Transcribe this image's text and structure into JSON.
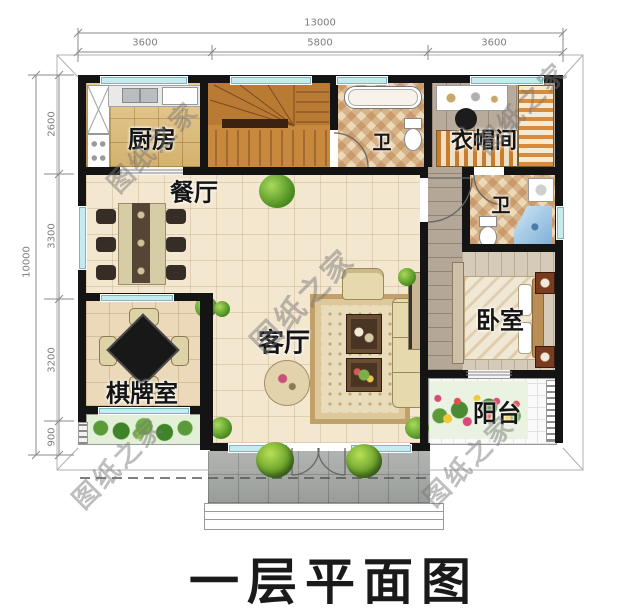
{
  "title": "一层平面图",
  "watermark": "图纸之家",
  "dims": {
    "top_total": "13000",
    "top_segs": [
      "3600",
      "5800",
      "3600"
    ],
    "left_total": "10000",
    "left_segs": [
      "2600",
      "3300",
      "3200",
      "900"
    ]
  },
  "rooms": {
    "kitchen": "厨房",
    "dining": "餐厅",
    "bath_top": "卫",
    "cloakroom": "衣帽间",
    "bath_right": "卫",
    "bedroom": "卧室",
    "chess": "棋牌室",
    "living": "客厅",
    "balcony": "阳台"
  }
}
